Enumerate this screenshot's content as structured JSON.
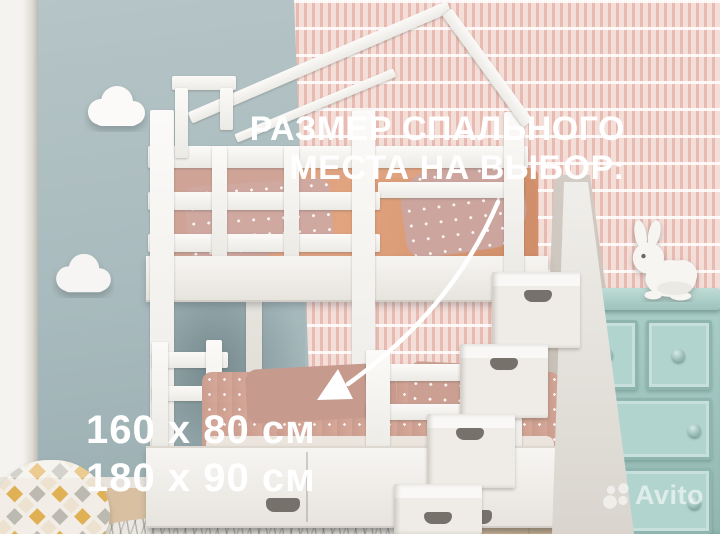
{
  "overlay": {
    "headline_line1": "РАЗМЕР СПАЛЬНОГО",
    "headline_line2": "МЕСТА НА ВЫБОР:",
    "size_option_1": "160 x 80 см",
    "size_option_2": "180 x 90 см",
    "text_color": "#ffffff"
  },
  "watermark": {
    "brand": "Avito"
  },
  "palette": {
    "wall_left": "#aabcbe",
    "wallpaper": "#f3ded8",
    "wallpaper_stroke": "#de9c92",
    "bed_white": "#f6f4f1",
    "bedding_top_bunk": "#dfa381",
    "bedding_bottom_bunk": "#cfa195",
    "dresser_teal": "#a9cdc7",
    "floor_wood": "#d9c0a1",
    "arrow": "#ffffff"
  },
  "scene_items": [
    "house-frame-bunk-bed",
    "storage-staircase",
    "under-bed-drawers",
    "teal-dresser",
    "bunny-figurine",
    "cloud-wall-lamps",
    "patterned-pouf",
    "rug"
  ]
}
